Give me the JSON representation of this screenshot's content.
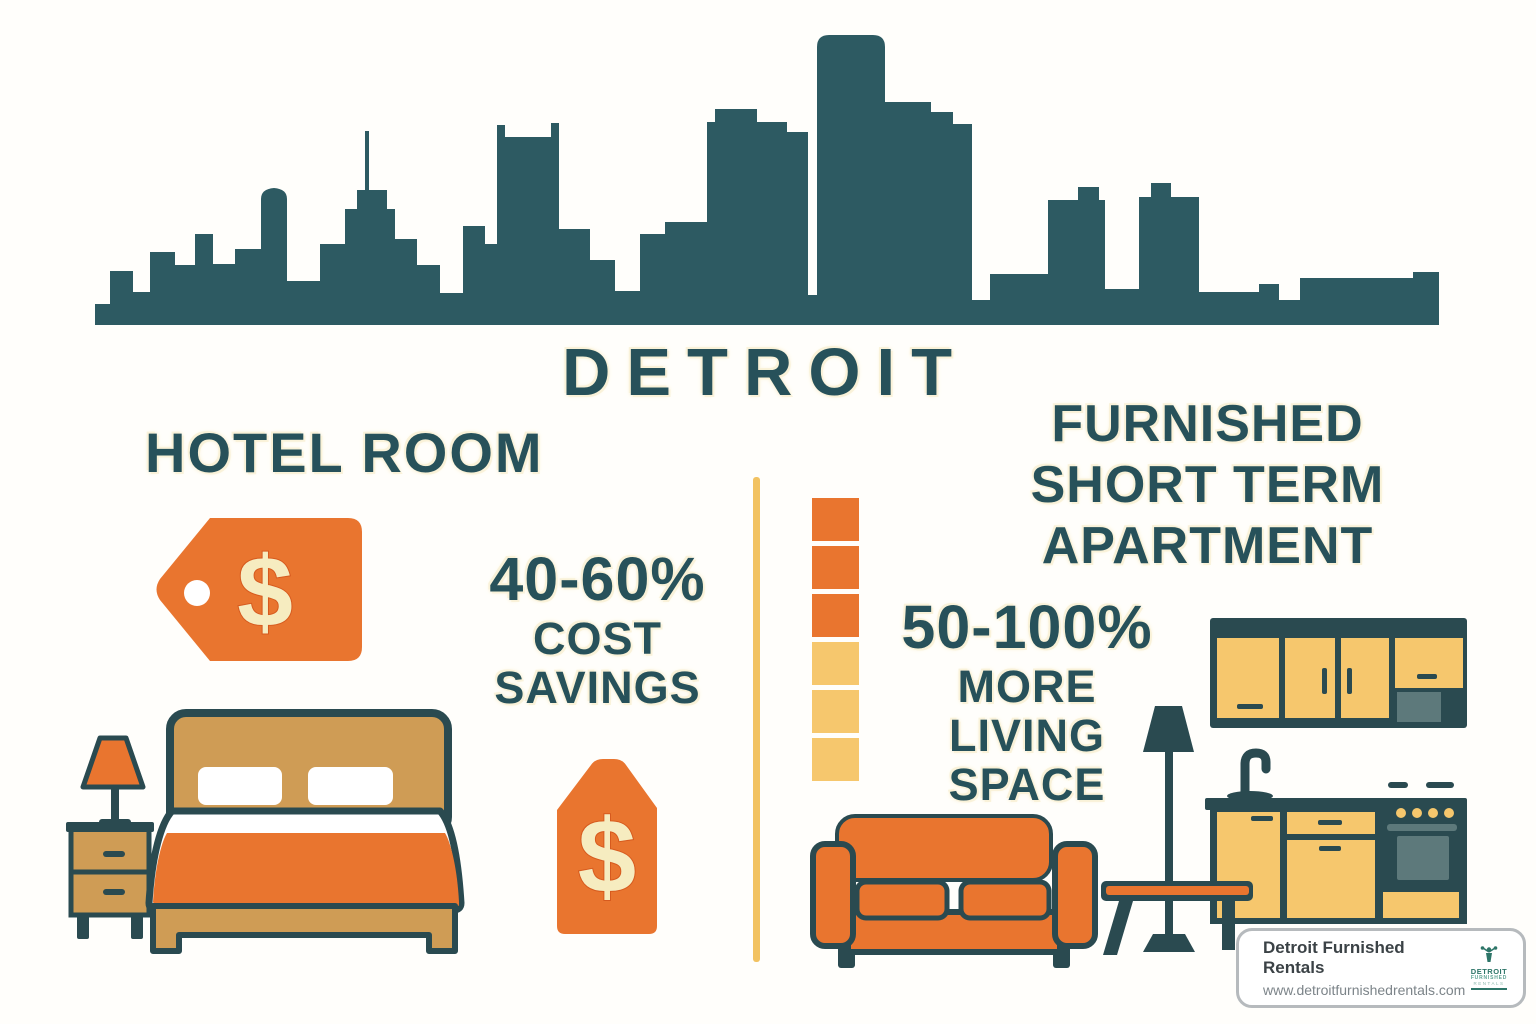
{
  "city_title": "DETROIT",
  "hotel": {
    "heading": "HOTEL ROOM",
    "tag1_symbol": "$",
    "tag2_symbol": "$",
    "stat_value": "40-60%",
    "stat_line1": "COST",
    "stat_line2": "SAVINGS"
  },
  "apartment": {
    "heading_line1": "FURNISHED",
    "heading_line2": "SHORT TERM",
    "heading_line3": "APARTMENT",
    "stat_value": "50-100%",
    "stat_line1": "MORE",
    "stat_line2": "LIVING",
    "stat_line3": "SPACE",
    "space_blocks": {
      "orange_count": 3,
      "yellow_count": 3
    }
  },
  "footer_card": {
    "brand_name": "Detroit Furnished Rentals",
    "website": "www.detroitfurnishedrentals.com",
    "logo_line1": "DETROIT",
    "logo_line2": "FURNISHED",
    "logo_line3": "RENTALS"
  },
  "colors": {
    "teal": "#2d5a62",
    "text_teal": "#27515a",
    "orange": "#e9752f",
    "yellow": "#f6c76d",
    "tan": "#cf9c55",
    "cream": "#f6ecc0",
    "divider_yellow": "#f2c261",
    "outline": "#2a4a50"
  }
}
